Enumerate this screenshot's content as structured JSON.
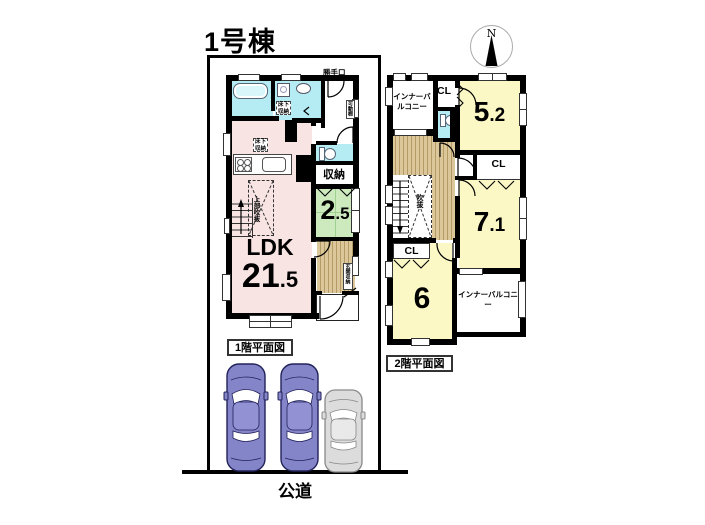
{
  "title": "1号棟",
  "compass_label": "N",
  "road_label": "公道",
  "floor1": {
    "caption": "1階平面図",
    "ldk_label": "LDK",
    "ldk_size_main": "21",
    "ldk_size_sub": ".5",
    "tatami_size_main": "2",
    "tatami_size_sub": ".5",
    "storage_label": "収納",
    "underfloor_label_1": "床下収納",
    "underfloor_label_2": "床下収納",
    "backdoor_label": "勝手口",
    "movable_shelf_label": "可動棚",
    "entrance_storage_label": "玄関収納",
    "void_above_label": "上部吹抜"
  },
  "floor2": {
    "caption": "2階平面図",
    "inner_balcony_top_label": "インナーバルコニー",
    "inner_balcony_bottom_label": "インナーバルコニー",
    "cl_top_label": "CL",
    "cl_mid_label": "CL",
    "cl_bottom_label": "CL",
    "room52_main": "5",
    "room52_sub": ".2",
    "room71_main": "7",
    "room71_sub": ".1",
    "room6_main": "6",
    "void_label": "吹抜"
  },
  "colors": {
    "room_pink": "#f9e4e4",
    "room_cyan": "#b5ecf4",
    "room_green": "#cdeabf",
    "room_yellow": "#fbf8c6",
    "wood": "#dcc79a",
    "car_blue": "#8484c9",
    "car_gray": "#dcdcdc"
  }
}
